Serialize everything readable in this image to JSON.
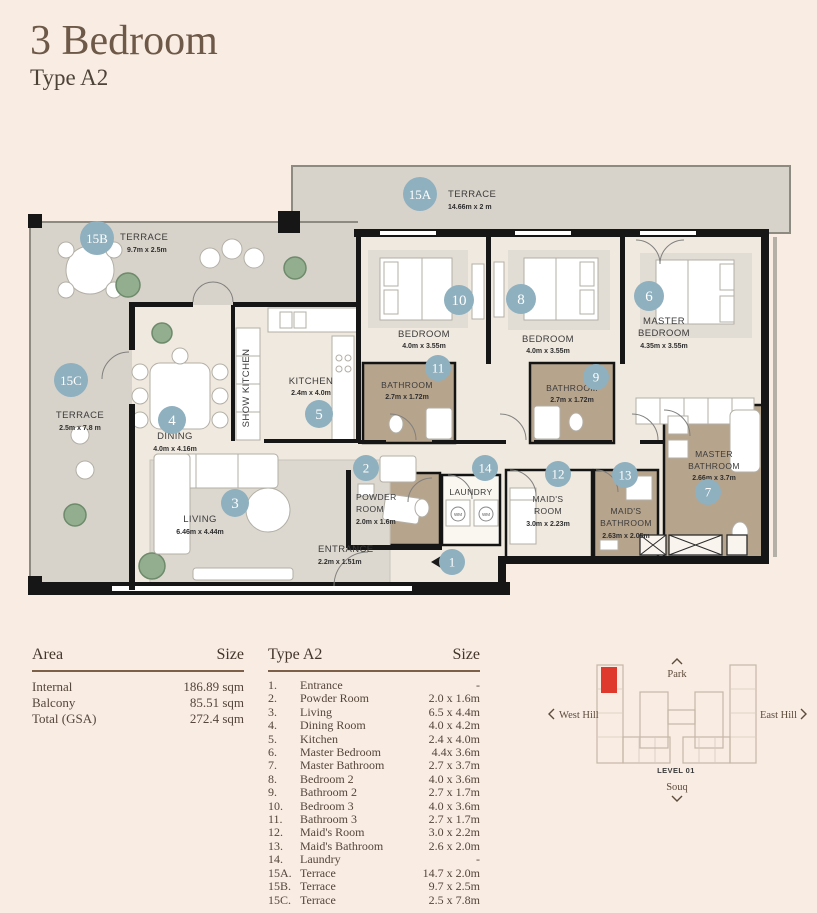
{
  "header": {
    "title": "3 Bedroom",
    "subtitle": "Type A2"
  },
  "plan": {
    "rooms": {
      "terrace_a": {
        "badge": "15A",
        "name": "TERRACE",
        "dims": "14.66m x 2 m"
      },
      "terrace_b": {
        "badge": "15B",
        "name": "TERRACE",
        "dims": "9.7m x 2.5m"
      },
      "terrace_c": {
        "badge": "15C",
        "name": "TERRACE",
        "dims": "2.5m x 7.8 m"
      },
      "dining": {
        "badge": "4",
        "name": "DINING",
        "dims": "4.0m x 4.16m"
      },
      "kitchen": {
        "badge": "5",
        "name": "KITCHEN",
        "dims": "2.4m x 4.0m"
      },
      "show_kitchen": {
        "name": "SHOW KITCHEN"
      },
      "living": {
        "badge": "3",
        "name": "LIVING",
        "dims": "6.46m x 4.44m"
      },
      "bedroom3": {
        "badge": "10",
        "name": "BEDROOM",
        "dims": "4.0m x 3.55m"
      },
      "bedroom2": {
        "badge": "8",
        "name": "BEDROOM",
        "dims": "4.0m x 3.55m"
      },
      "master_bedroom": {
        "badge": "6",
        "line1": "MASTER",
        "line2": "BEDROOM",
        "dims": "4.35m x 3.55m"
      },
      "bathroom3": {
        "badge": "11",
        "name": "BATHROOM",
        "dims": "2.7m x 1.72m"
      },
      "bathroom2": {
        "badge": "9",
        "name": "BATHROOM",
        "dims": "2.7m x 1.72m"
      },
      "master_bathroom": {
        "badge": "7",
        "line1": "MASTER",
        "line2": "BATHROOM",
        "dims": "2.66m x 3.7m"
      },
      "powder": {
        "badge": "2",
        "line1": "POWDER",
        "line2": "ROOM",
        "dims": "2.0m x 1.6m"
      },
      "laundry": {
        "badge": "14",
        "name": "LAUNDRY"
      },
      "maids_room": {
        "badge": "12",
        "line1": "MAID'S",
        "line2": "ROOM",
        "dims": "3.0m x 2.23m"
      },
      "maids_bathroom": {
        "badge": "13",
        "line1": "MAID'S",
        "line2": "BATHROOM",
        "dims": "2.63m x 2.05m"
      },
      "entrance": {
        "badge": "1",
        "name": "ENTRANCE",
        "dims": "2.2m x 1.51m"
      }
    },
    "labels": {
      "wm": "WM"
    }
  },
  "area_table": {
    "col_area": "Area",
    "col_size": "Size",
    "rows": [
      {
        "label": "Internal",
        "size": "186.89 sqm"
      },
      {
        "label": "Balcony",
        "size": "85.51 sqm"
      },
      {
        "label": "Total (GSA)",
        "size": "272.4 sqm"
      }
    ]
  },
  "type_table": {
    "col_type": "Type A2",
    "col_size": "Size",
    "rows": [
      {
        "no": "1.",
        "label": "Entrance",
        "size": "-"
      },
      {
        "no": "2.",
        "label": "Powder Room",
        "size": "2.0 x 1.6m"
      },
      {
        "no": "3.",
        "label": "Living",
        "size": "6.5 x 4.4m"
      },
      {
        "no": "4.",
        "label": "Dining Room",
        "size": "4.0 x 4.2m"
      },
      {
        "no": "5.",
        "label": "Kitchen",
        "size": "2.4 x 4.0m"
      },
      {
        "no": "6.",
        "label": "Master Bedroom",
        "size": "4.4x 3.6m"
      },
      {
        "no": "7.",
        "label": "Master Bathroom",
        "size": "2.7 x 3.7m"
      },
      {
        "no": "8.",
        "label": "Bedroom 2",
        "size": "4.0 x 3.6m"
      },
      {
        "no": "9.",
        "label": "Bathroom 2",
        "size": "2.7 x 1.7m"
      },
      {
        "no": "10.",
        "label": "Bedroom 3",
        "size": "4.0 x 3.6m"
      },
      {
        "no": "11.",
        "label": "Bathroom 3",
        "size": "2.7 x 1.7m"
      },
      {
        "no": "12.",
        "label": "Maid's Room",
        "size": "3.0 x 2.2m"
      },
      {
        "no": "13.",
        "label": "Maid's Bathroom",
        "size": "2.6 x 2.0m"
      },
      {
        "no": "14.",
        "label": "Laundry",
        "size": "-"
      },
      {
        "no": "15A.",
        "label": "Terrace",
        "size": "14.7 x 2.0m"
      },
      {
        "no": "15B.",
        "label": "Terrace",
        "size": "9.7 x 2.5m"
      },
      {
        "no": "15C.",
        "label": "Terrace",
        "size": "2.5 x 7.8m"
      }
    ]
  },
  "sitemap": {
    "park": "Park",
    "west_hill": "West Hill",
    "east_hill": "East Hill",
    "level": "LEVEL 01",
    "souq": "Souq"
  },
  "colors": {
    "badge": "#8fb0bf",
    "bathroom": "#b7a48c",
    "terrace": "#d8d3ca",
    "interior": "#f0e9df",
    "wall": "#161616",
    "accent_red": "#df382c",
    "title": "#6e5948"
  }
}
